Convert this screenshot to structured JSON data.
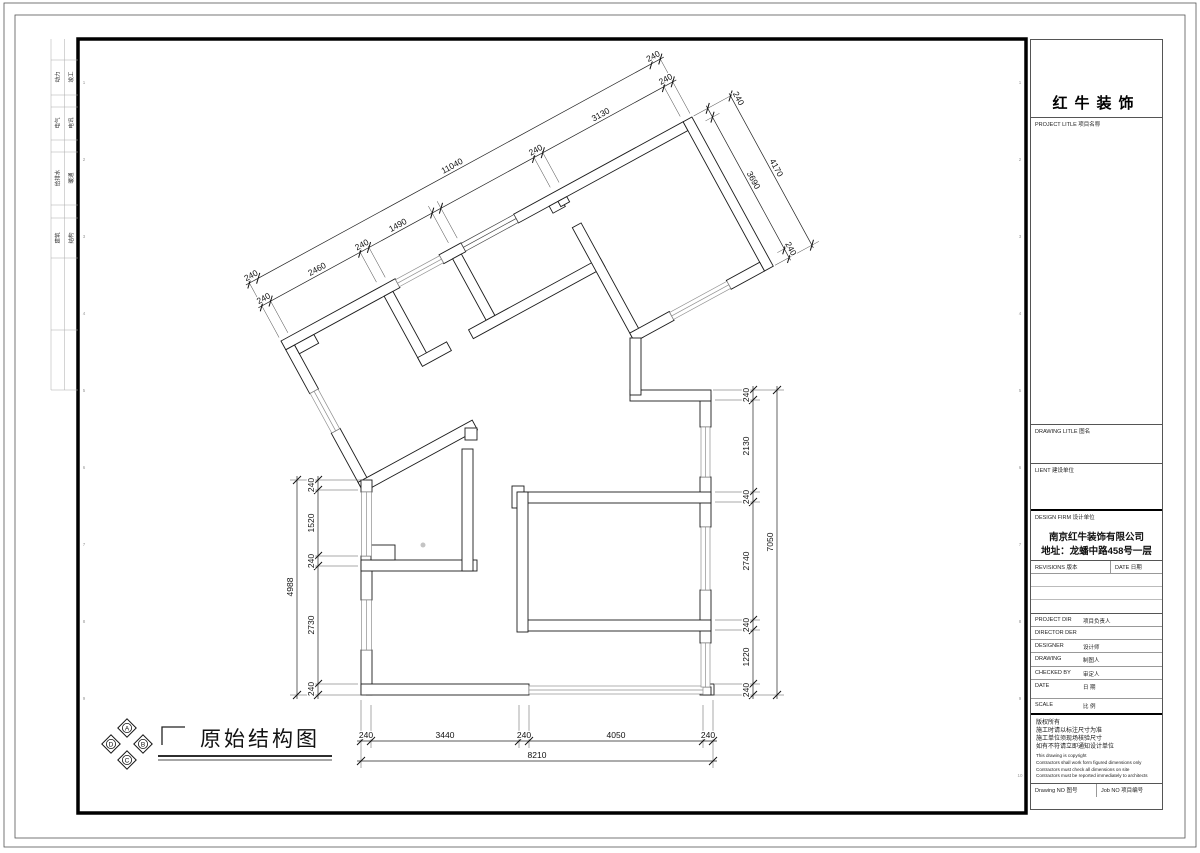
{
  "sheet": {
    "discipline_strip": {
      "rows": [
        {
          "left": "动力",
          "right": "竣工"
        },
        {
          "left": "电气",
          "right": "电讯"
        },
        {
          "left": "给排水",
          "right": "暖通"
        },
        {
          "left": "建筑",
          "right": "结构"
        }
      ]
    },
    "grid_labels": [
      "1",
      "2",
      "3",
      "4",
      "5",
      "6",
      "7",
      "8",
      "9",
      "10"
    ]
  },
  "plan": {
    "title": "原始结构图",
    "compass": {
      "top": "A",
      "right": "B",
      "bottom": "C",
      "left": "D"
    },
    "dims": {
      "d240": "240",
      "d11040": "11040",
      "d2460": "2460",
      "d1490": "1490",
      "d3130": "3130",
      "d4170": "4170",
      "d3690": "3690",
      "d2130": "2130",
      "d2740": "2740",
      "d1220": "1220",
      "d7050": "7050",
      "d1520": "1520",
      "d2730": "2730",
      "d4988": "4988",
      "d3440": "3440",
      "d4050": "4050",
      "d8210": "8210"
    }
  },
  "title_block": {
    "brand": "红牛装饰",
    "project_title_label": "PROJECT LITLE  项目名称",
    "drawing_title_label": "DRAWING LITLE  图名",
    "client_label": "LIENT  建设单位",
    "design_firm_label": "DESIGN FIRM  设计单位",
    "firm_name": "南京红牛装饰有限公司",
    "firm_address": "地址：龙蟠中路458号一层",
    "revisions_label": "REVISIONS  版本",
    "revision_date_label": "DATE  日期",
    "staff_rows": [
      {
        "en": "PROJECT DIR",
        "zh": "项目负责人"
      },
      {
        "en": "DIRECTOR DER",
        "zh": ""
      },
      {
        "en": "DESIGNER",
        "zh": "设计师"
      },
      {
        "en": "DRAWING",
        "zh": "制图人"
      },
      {
        "en": "CHECKED BY",
        "zh": "审定人"
      },
      {
        "en": "DATE",
        "zh": "日  期"
      },
      {
        "en": "SCALE",
        "zh": "比  例"
      }
    ],
    "notice_zh": [
      "版权所有",
      "施工时请以标注尺寸为准",
      "施工单位须现场核验尺寸",
      "如有不符请立即通知设计单位"
    ],
    "notice_en": [
      "This drawing is copyright",
      "Contractors shall work form figured dimensions only",
      "Contractors must check all dimensions on site",
      "Contractors must be reported immediately to architects"
    ],
    "drawing_no_label": "Drawing NO  图号",
    "job_no_label": "Job NO  项目编号"
  }
}
